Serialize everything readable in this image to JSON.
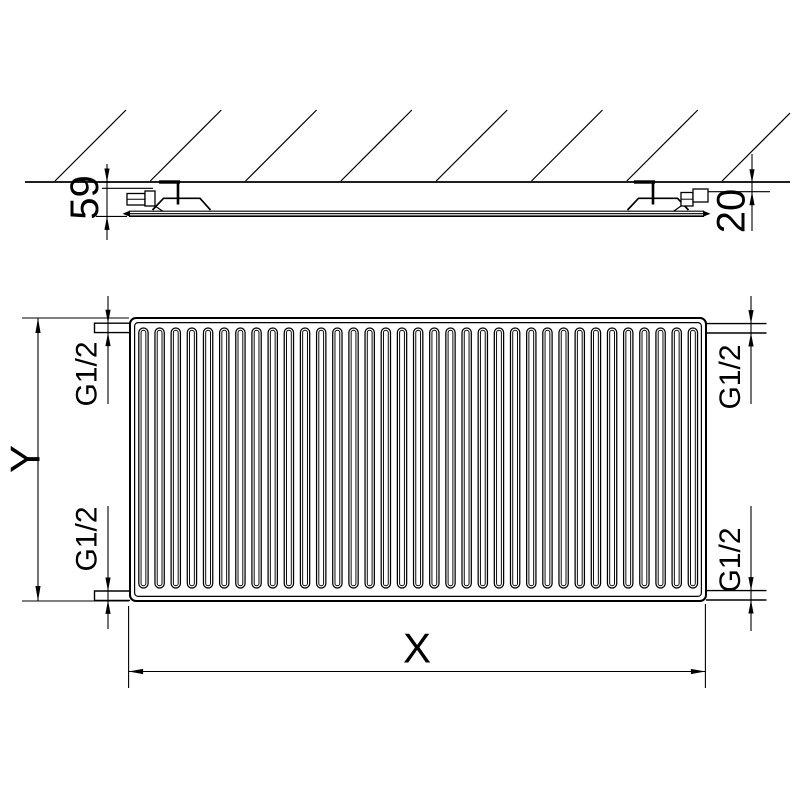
{
  "page": {
    "background": "#ffffff",
    "line_color": "#000000"
  },
  "top_view": {
    "dims": {
      "depth": "59",
      "wall_gap": "20"
    }
  },
  "front_view": {
    "fin_count": 35,
    "dims": {
      "height": "Y",
      "width": "X",
      "conn_top_left": "G1/2",
      "conn_top_right": "G1/2",
      "conn_bottom_left": "G1/2",
      "conn_bottom_right": "G1/2"
    }
  }
}
